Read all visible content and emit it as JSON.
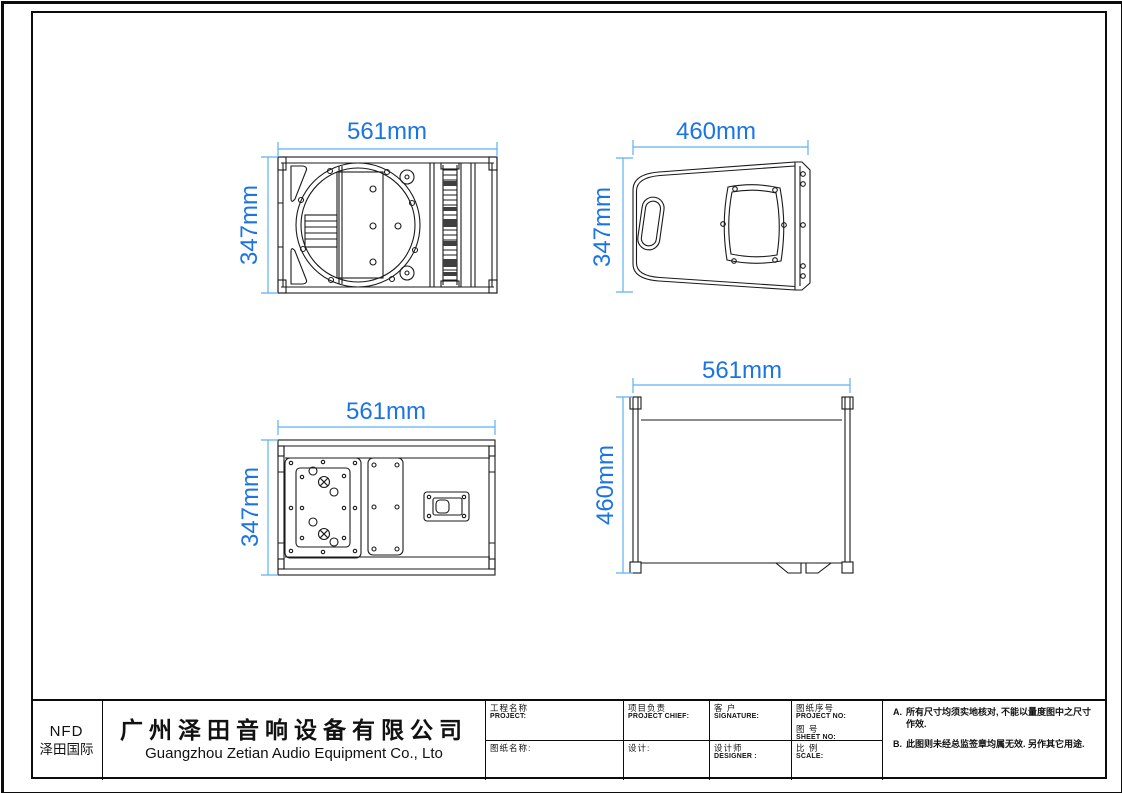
{
  "views": {
    "front": {
      "width_label": "561mm",
      "height_label": "347mm"
    },
    "side": {
      "width_label": "460mm",
      "height_label": "347mm"
    },
    "rear": {
      "width_label": "561mm",
      "height_label": "347mm"
    },
    "top": {
      "width_label": "561mm",
      "height_label": "460mm"
    }
  },
  "title_block": {
    "logo_line1": "NFD",
    "logo_line2": "泽田国际",
    "company_cn": "广州泽田音响设备有限公司",
    "company_en": "Guangzhou Zetian Audio Equipment Co., Lto",
    "fields": {
      "project_cn": "工程名称",
      "project_en": "PROJECT:",
      "chief_cn": "项目负责",
      "chief_en": "PROJECT CHIEF:",
      "customer_cn": "客 户",
      "customer_en": "SIGNATURE:",
      "drawing_no_cn": "图纸序号",
      "drawing_no_en": "PROJECT NO:",
      "sheet_no_cn": "图 号",
      "sheet_no_en": "SHEET NO:",
      "drawing_name_cn": "图纸名称:",
      "design_cn": "设计:",
      "designer_cn": "设计师",
      "designer_en": "DESIGNER :",
      "scale_cn": "比 例",
      "scale_en": "SCALE:"
    },
    "notes": {
      "a_label": "A.",
      "a_text": "所有尺寸均须实地核对, 不能以量度图中之尺寸作效.",
      "b_label": "B.",
      "b_text": "此图则未经总监签章均属无效. 另作其它用途."
    }
  },
  "colors": {
    "dimension_text": "#1b74e4",
    "dimension_line": "#5fb0f0",
    "line_work": "#1a1a1a"
  }
}
